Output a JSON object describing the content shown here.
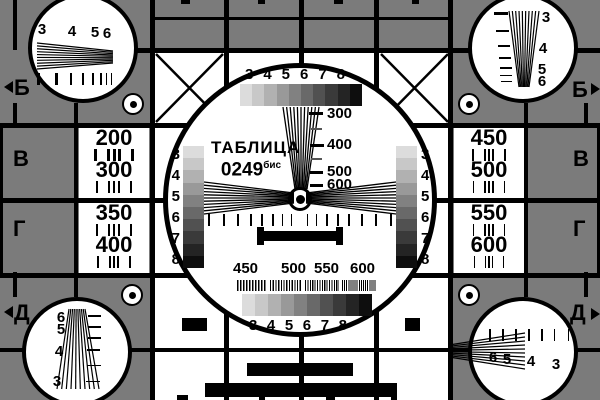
{
  "colors": {
    "background": "#7b7b7b",
    "ink": "#000000",
    "panel": "#ffffff",
    "grayscale_steps": [
      "#dcdcdc",
      "#c8c8c8",
      "#b1b1b1",
      "#999999",
      "#818181",
      "#696969",
      "#515151",
      "#3a3a3a",
      "#242424",
      "#0e0e0e"
    ]
  },
  "title": {
    "name": "ТАБЛИЦА",
    "number": "0249",
    "suffix": "бис"
  },
  "center_circle": {
    "top_scale_numbers": [
      "3",
      "4",
      "5",
      "6",
      "7",
      "8"
    ],
    "bottom_scale_numbers": [
      "3",
      "4",
      "5",
      "6",
      "7",
      "8"
    ],
    "left_scale_numbers": [
      "3",
      "4",
      "5",
      "6",
      "7",
      "8"
    ],
    "right_scale_numbers": [
      "3",
      "4",
      "5",
      "6",
      "7",
      "8"
    ],
    "wedge_labels": [
      "300",
      "400",
      "500",
      "600"
    ],
    "burst_labels": [
      "450",
      "500",
      "550",
      "600"
    ]
  },
  "side_panels": {
    "left_top": {
      "values": [
        "200",
        "300"
      ]
    },
    "left_bottom": {
      "values": [
        "350",
        "400"
      ]
    },
    "right_top": {
      "values": [
        "450",
        "500"
      ]
    },
    "right_bottom": {
      "values": [
        "550",
        "600"
      ]
    }
  },
  "row_labels": {
    "left": [
      "Б",
      "В",
      "Г",
      "Д"
    ],
    "right": [
      "Б",
      "В",
      "Г",
      "Д"
    ]
  },
  "corner_circles": {
    "top_left": [
      "3",
      "4",
      "5",
      "6"
    ],
    "top_right": [
      "3",
      "4",
      "5",
      "6"
    ],
    "bottom_left": [
      "6",
      "5",
      "4",
      "3"
    ],
    "bottom_right": [
      "6",
      "5",
      "4",
      "3"
    ]
  }
}
